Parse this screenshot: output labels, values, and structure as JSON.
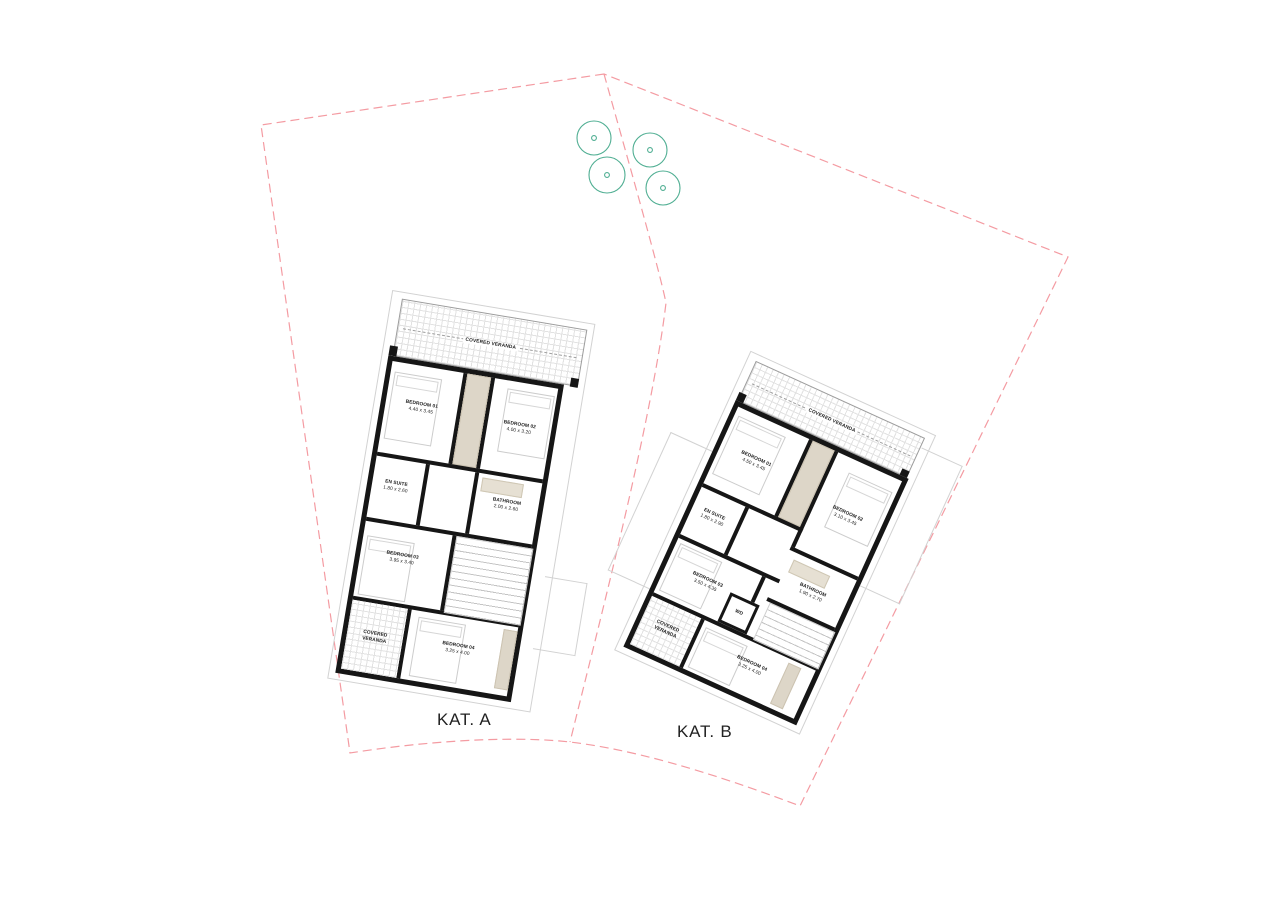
{
  "site": {
    "lot_labels": [
      {
        "label": "KAT. A"
      },
      {
        "label": "KAT. B"
      }
    ],
    "boundary_color": "#f49ba2",
    "tree_color": "#4fae92",
    "trees": {
      "count": 4
    }
  },
  "houses": [
    {
      "name": "KAT. A",
      "rooms": [
        {
          "label": "COVERED VERANDA",
          "dims": ""
        },
        {
          "label": "BEDROOM 01",
          "dims": "4.40 x 3.45"
        },
        {
          "label": "BEDROOM 02",
          "dims": "4.00 x 3.20"
        },
        {
          "label": "EN SUITE",
          "dims": "1.80 x 2.60"
        },
        {
          "label": "BATHROOM",
          "dims": "2.00 x 2.60"
        },
        {
          "label": "BEDROOM 03",
          "dims": "3.95 x 3.40"
        },
        {
          "label": "COVERED VERANDA",
          "dims": ""
        },
        {
          "label": "BEDROOM 04",
          "dims": "3.25 x 4.00"
        }
      ]
    },
    {
      "name": "KAT. B",
      "rooms": [
        {
          "label": "COVERED VERANDA",
          "dims": ""
        },
        {
          "label": "BEDROOM 01",
          "dims": "4.50 x 3.45"
        },
        {
          "label": "BEDROOM 02",
          "dims": "3.10 x 3.45"
        },
        {
          "label": "EN SUITE",
          "dims": "1.80 x 2.90"
        },
        {
          "label": "BATHROOM",
          "dims": "1.90 x 2.70"
        },
        {
          "label": "BEDROOM 03",
          "dims": "3.50 x 4.35"
        },
        {
          "label": "WD",
          "dims": ""
        },
        {
          "label": "COVERED VERANDA",
          "dims": ""
        },
        {
          "label": "BEDROOM 04",
          "dims": "3.25 x 4.00"
        }
      ]
    }
  ]
}
